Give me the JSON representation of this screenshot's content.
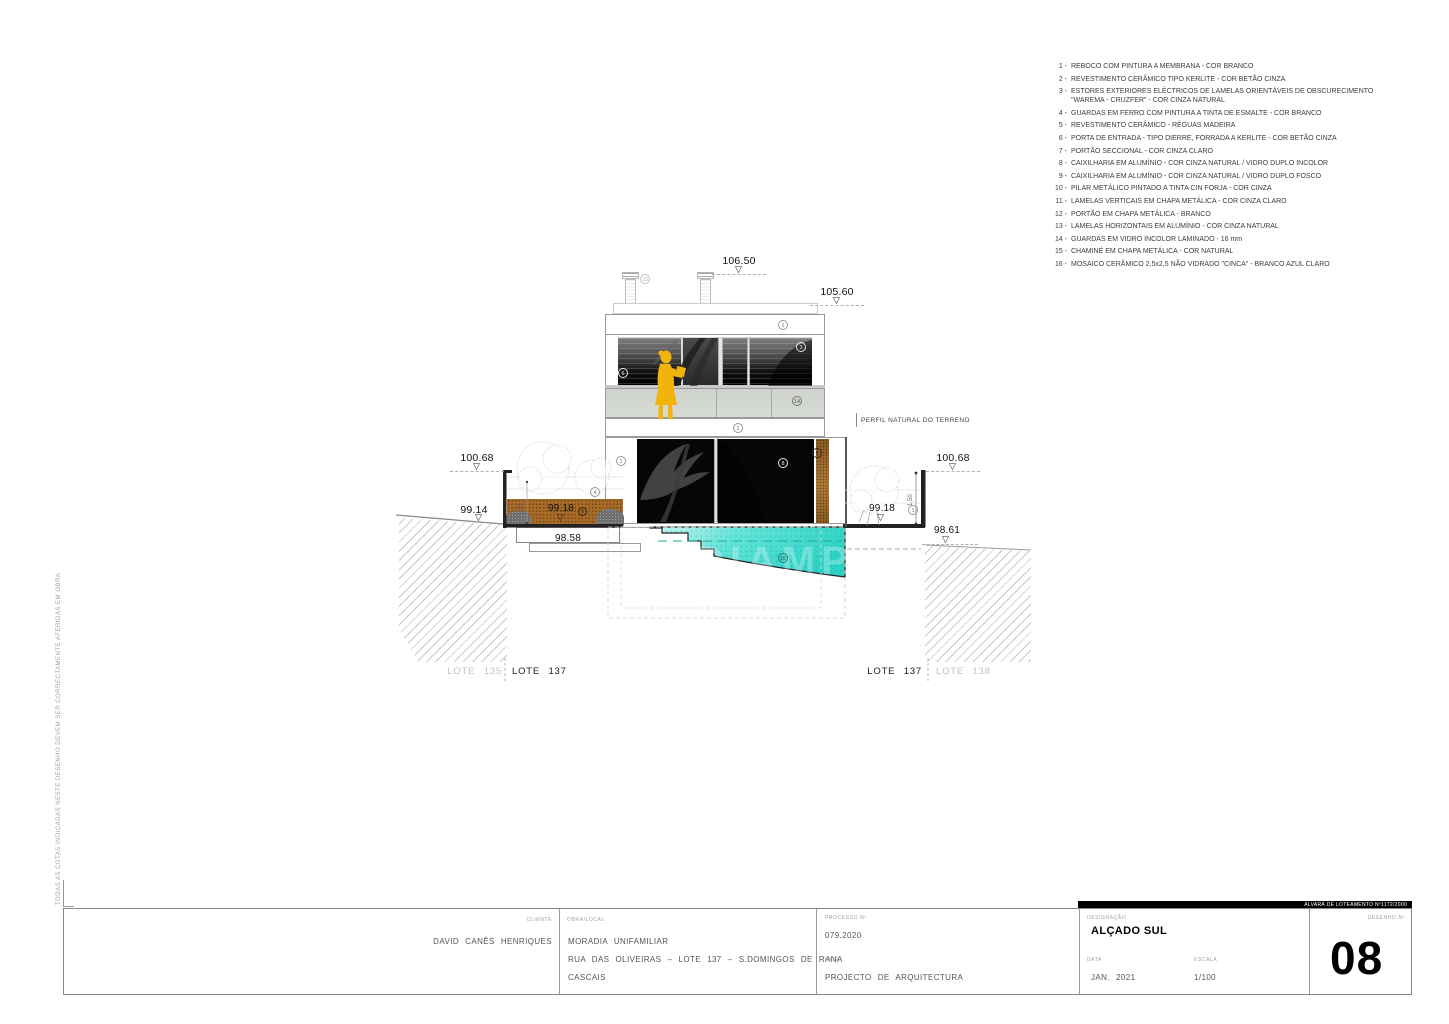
{
  "legend": {
    "items": [
      {
        "num": "1",
        "text": "REBOCO COM PINTURA A MEMBRANA - COR BRANCO"
      },
      {
        "num": "2",
        "text": "REVESTIMENTO CERÂMICO TIPO KERLITE - COR BETÃO CINZA"
      },
      {
        "num": "3",
        "text": "ESTORES EXTERIORES ELÉCTRICOS DE LAMELAS ORIENTÁVEIS DE OBSCURECIMENTO \"WAREMA - CRUZFER\" - COR CINZA NATURAL"
      },
      {
        "num": "4",
        "text": "GUARDAS EM FERRO COM PINTURA A TINTA DE ESMALTE - COR BRANCO"
      },
      {
        "num": "5",
        "text": "REVESTIMENTO CERÂMICO - RÉGUAS MADEIRA"
      },
      {
        "num": "6",
        "text": "PORTA DE ENTRADA - TIPO DIERRE, FORRADA A KERLITE - COR BETÃO CINZA"
      },
      {
        "num": "7",
        "text": "PORTÃO SECCIONAL - COR CINZA CLARO"
      },
      {
        "num": "8",
        "text": "CAIXILHARIA EM ALUMÍNIO - COR CINZA NATURAL / VIDRO DUPLO INCOLOR"
      },
      {
        "num": "9",
        "text": "CAIXILHARIA EM ALUMÍNIO - COR CINZA NATURAL / VIDRO DUPLO FOSCO"
      },
      {
        "num": "10",
        "text": "PILAR METÁLICO PINTADO A TINTA CIN FORJA - COR CINZA"
      },
      {
        "num": "11",
        "text": "LAMELAS VERTICAIS EM CHAPA METÁLICA - COR CINZA CLARO"
      },
      {
        "num": "12",
        "text": "PORTÃO EM CHAPA METÁLICA - BRANCO"
      },
      {
        "num": "13",
        "text": "LAMELAS HORIZONTAIS EM ALUMÍNIO - COR CINZA NATURAL"
      },
      {
        "num": "14",
        "text": "GUARDAS EM VIDRO INCOLOR LAMINADO - 16 mm"
      },
      {
        "num": "15",
        "text": "CHAMINÉ EM CHAPA METÁLICA - COR NATURAL"
      },
      {
        "num": "16",
        "text": "MOSAICO CERÂMICO 2,5x2,5 NÃO VIDRADO \"CINCA\" - BRANCO AZUL CLARO"
      }
    ]
  },
  "elevations": {
    "top": "106.50",
    "roof": "105.60",
    "wall_left": "100.68",
    "wall_right": "100.68",
    "street_left": "99.14",
    "terrace_left": "99.18",
    "terrace_right": "99.18",
    "steps": "98.58",
    "ground_right": "98.61"
  },
  "dims": {
    "wall_height_right": "1,50",
    "planter_left": "50"
  },
  "notes": {
    "terrain_profile": "PERFIL NATURAL DO TERRENO"
  },
  "lots": {
    "left_a": "LOTE 135",
    "left_b": "LOTE 137",
    "right_a": "LOTE 137",
    "right_b": "LOTE 138"
  },
  "callouts": {
    "chimney": "15",
    "roof_band": "1",
    "estores": "3",
    "entry_door": "6",
    "glass_guard": "14",
    "mid_band": "1",
    "lower_wall": "1",
    "window": "8",
    "wood_cladding": "5",
    "iron_guard": "4",
    "planter_wood": "5",
    "site_wall": "1",
    "pool_mosaic": "16"
  },
  "titleblock": {
    "client_label": "CLIENTE",
    "client": "DAVID CANÊS HENRIQUES",
    "site_label": "OBRA/LOCAL",
    "site_line1": "MORADIA UNIFAMILIAR",
    "site_line2": "RUA DAS OLIVEIRAS – LOTE 137 – S.DOMINGOS DE RANA",
    "site_line3": "CASCAIS",
    "process_label": "PROCESSO Nº",
    "process": "079.2020",
    "phase_label": "FASE",
    "phase": "PROJECTO DE ARQUITECTURA",
    "permit": "ALVARÁ DE LOTEAMENTO Nº1172/2000",
    "designation_label": "DESIGNAÇÃO",
    "designation": "ALÇADO SUL",
    "date_label": "DATA",
    "date": "JAN. 2021",
    "scale_label": "ESCALA",
    "scale": "1/100",
    "number_label": "DESENHO Nº",
    "number": "08"
  },
  "side_note": "TODAS AS COTAS INDICADAS NESTE DESENHO DEVEM SER CORRECTAMENTE AFERIDAS EM OBRA",
  "watermark_text": "DIAMP",
  "icons": {
    "level_marker": "▽"
  },
  "colors": {
    "person": "#F2B30B",
    "pool": "#45DFD3",
    "planter_soil": "#A96B28",
    "wood_cladding": "#8A5A22",
    "permit_bar": "#000000"
  }
}
